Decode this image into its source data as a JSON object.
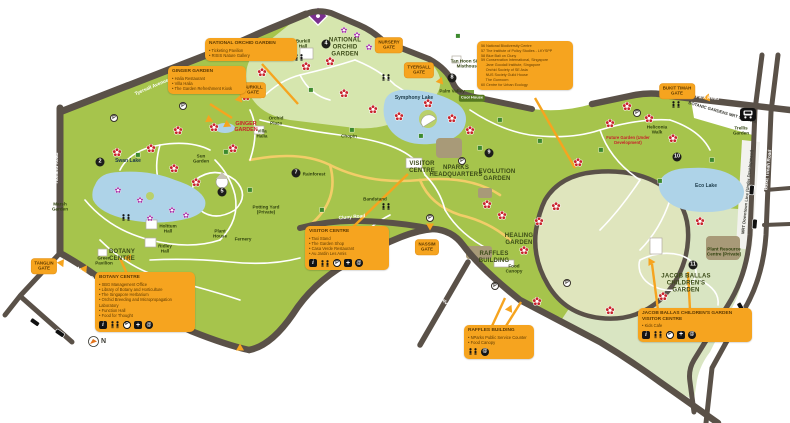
{
  "title": "Singapore Botanic Gardens Visitor Map",
  "colors": {
    "garden_green": "#a6c44c",
    "pale_garden": "#d6e6ae",
    "lawn": "#dfe5bd",
    "road": "#5a5148",
    "water": "#aed3e8",
    "callout_orange": "#f6a41f",
    "callout_text": "#5e3a00",
    "flower_red": "#c8232c",
    "flower_purple": "#a531a8",
    "path_yellow": "#f2cd68"
  },
  "compass": {
    "label": "N"
  },
  "legend_box": {
    "x": 477,
    "y": 41,
    "w": 88,
    "items": [
      {
        "n": "56",
        "t": "National Biodiversity Centre"
      },
      {
        "n": "57",
        "t": "The Institute of Policy Studies - LKYSPP"
      },
      {
        "n": "58",
        "t": "Blue Bali on Cluny"
      },
      {
        "n": "59",
        "t": "Conservation International, Singapore"
      },
      {
        "n": "",
        "t": "Jane Goodall Institute, Singapore"
      },
      {
        "n": "",
        "t": "Orchid Society of SE Asia"
      },
      {
        "n": "",
        "t": "NUS Society Guild House"
      },
      {
        "n": "",
        "t": "The Gunroom"
      },
      {
        "n": "60",
        "t": "Centre for Urban Ecology"
      }
    ],
    "tails": [
      [
        535,
        98,
        575,
        168
      ]
    ]
  },
  "callouts": [
    {
      "slug": "national-orchid-garden",
      "x": 205,
      "y": 38,
      "w": 84,
      "title": "National Orchid Garden",
      "bullets": [
        "Ticketing Pavilion",
        "RISIS Nature Gallery"
      ],
      "icons": [],
      "tails": [
        [
          262,
          64,
          298,
          104
        ]
      ]
    },
    {
      "slug": "ginger-garden",
      "x": 168,
      "y": 66,
      "w": 70,
      "title": "Ginger Garden",
      "bullets": [
        "Halia Restaurant",
        "Villa Halia",
        "The Garden Refreshment Kiosk"
      ],
      "icons": [],
      "tails": [
        [
          210,
          104,
          232,
          118
        ]
      ]
    },
    {
      "slug": "botany-centre",
      "x": 95,
      "y": 272,
      "w": 92,
      "title": "Botany Centre",
      "bullets": [
        "SBG Management Office",
        "Library of Botany and Horticulture",
        "The Singapore Herbarium",
        "Orchid Breeding and Micropropagation Laboratory",
        "Function Hall",
        "Food for Thought"
      ],
      "icons": [
        "info",
        "wc",
        "p",
        "fa",
        "cafe"
      ],
      "tails": [
        [
          127,
          274,
          120,
          258
        ]
      ]
    },
    {
      "slug": "visitor-centre",
      "x": 305,
      "y": 226,
      "w": 76,
      "title": "Visitor Centre",
      "bullets": [
        "Taxi Stand",
        "The Garden Shop",
        "Casa Verde Restaurant",
        "Au Jardin Les Amis"
      ],
      "icons": [
        "info",
        "wc",
        "p",
        "fa",
        "cafe"
      ],
      "tails": [
        [
          352,
          228,
          408,
          174
        ]
      ]
    },
    {
      "slug": "raffles-building",
      "x": 464,
      "y": 325,
      "w": 62,
      "title": "Raffles Building",
      "bullets": [
        "NParks Public Service Counter",
        "Food Canopy"
      ],
      "icons": [
        "wc",
        "cafe"
      ],
      "tails": [
        [
          492,
          326,
          505,
          298
        ],
        [
          506,
          326,
          521,
          302
        ]
      ]
    },
    {
      "slug": "jacob-ballas-visitor-centre",
      "x": 638,
      "y": 308,
      "w": 106,
      "title": "Jacob Ballas Children's Garden Visitor Centre",
      "bullets": [
        "Kids Cafe"
      ],
      "icons": [
        "info",
        "wc",
        "p",
        "fa",
        "cafe"
      ],
      "tails": [
        [
          658,
          310,
          652,
          264
        ],
        [
          690,
          310,
          688,
          272
        ]
      ]
    }
  ],
  "gates": [
    {
      "slug": "tanglin-gate",
      "t": "TANGLIN\nGATE",
      "x": 44,
      "y": 266
    },
    {
      "slug": "nassim-gate",
      "t": "NASSIM\nGATE",
      "x": 427,
      "y": 247
    },
    {
      "slug": "burkill-gate",
      "t": "BURKILL\nGATE",
      "x": 253,
      "y": 90
    },
    {
      "slug": "nursery-gate",
      "t": "NURSERY\nGATE",
      "x": 389,
      "y": 45
    },
    {
      "slug": "tyersall-gate",
      "t": "TYERSALL\nGATE",
      "x": 419,
      "y": 70
    },
    {
      "slug": "bukit-timah-gate",
      "t": "BUKIT TIMAH\nGATE",
      "x": 677,
      "y": 91
    }
  ],
  "map": {
    "labels": [
      {
        "t": "NATIONAL ORCHID GARDEN",
        "x": 345,
        "y": 48,
        "c": "rg",
        "w": 48
      },
      {
        "t": "GINGER GARDEN",
        "x": 246,
        "y": 127,
        "c": "redb",
        "w": 34
      },
      {
        "t": "VISITOR CENTRE",
        "x": 422,
        "y": 168,
        "c": "rg",
        "w": 34
      },
      {
        "t": "NPARKS HEADQUARTERS",
        "x": 456,
        "y": 172,
        "c": "rg",
        "w": 54
      },
      {
        "t": "EVOLUTION GARDEN",
        "x": 497,
        "y": 176,
        "c": "rg",
        "w": 42
      },
      {
        "t": "HEALING GARDEN",
        "x": 519,
        "y": 240,
        "c": "rg",
        "w": 36
      },
      {
        "t": "RAFFLES BUILDING",
        "x": 494,
        "y": 258,
        "c": "rg",
        "w": 38
      },
      {
        "t": "JACOB BALLAS CHILDREN'S GARDEN",
        "x": 686,
        "y": 284,
        "c": "rg",
        "w": 50
      },
      {
        "t": "BOTANY CENTRE",
        "x": 122,
        "y": 256,
        "c": "rg",
        "w": 34
      },
      {
        "t": "Swan Lake",
        "x": 128,
        "y": 162,
        "c": "lk"
      },
      {
        "t": "Symphony Lake",
        "x": 414,
        "y": 99,
        "c": "lk"
      },
      {
        "t": "Eco Lake",
        "x": 706,
        "y": 187,
        "c": "lk"
      },
      {
        "t": "Palm Valley",
        "x": 452,
        "y": 91,
        "c": "ft",
        "w": 26
      },
      {
        "t": "Cool House",
        "x": 472,
        "y": 98,
        "c": "gbox"
      },
      {
        "t": "Burkill Hall",
        "x": 303,
        "y": 44,
        "c": "ft",
        "w": 22
      },
      {
        "t": "Tan Hoon Siang Misthouse",
        "x": 468,
        "y": 64,
        "c": "ft",
        "w": 40
      },
      {
        "t": "Rainforest",
        "x": 314,
        "y": 174,
        "c": "ft"
      },
      {
        "t": "Bandstand",
        "x": 375,
        "y": 199,
        "c": "ft"
      },
      {
        "t": "Marsh Garden",
        "x": 60,
        "y": 207,
        "c": "ft",
        "w": 24
      },
      {
        "t": "Sun Garden",
        "x": 201,
        "y": 159,
        "c": "ft",
        "w": 22
      },
      {
        "t": "Villa Halia",
        "x": 262,
        "y": 134,
        "c": "ft",
        "w": 20
      },
      {
        "t": "Orchid Plaza",
        "x": 276,
        "y": 121,
        "c": "ft",
        "w": 22
      },
      {
        "t": "Plant House",
        "x": 220,
        "y": 234,
        "c": "ft",
        "w": 22
      },
      {
        "t": "Fernery",
        "x": 243,
        "y": 239,
        "c": "ft"
      },
      {
        "t": "Holttum Hall",
        "x": 168,
        "y": 229,
        "c": "ft",
        "w": 24
      },
      {
        "t": "Ridley Hall",
        "x": 165,
        "y": 249,
        "c": "ft",
        "w": 22
      },
      {
        "t": "Green Pavilion",
        "x": 104,
        "y": 261,
        "c": "ft",
        "w": 26
      },
      {
        "t": "Potting Yard (Private)",
        "x": 266,
        "y": 210,
        "c": "ft",
        "w": 30
      },
      {
        "t": "Food Canopy",
        "x": 514,
        "y": 269,
        "c": "ft",
        "w": 24
      },
      {
        "t": "Plant Resource Centre (Private)",
        "x": 724,
        "y": 252,
        "c": "ft",
        "w": 40
      },
      {
        "t": "Trellis Garden",
        "x": 741,
        "y": 131,
        "c": "ft",
        "w": 24
      },
      {
        "t": "Heliconia Walk",
        "x": 657,
        "y": 130,
        "c": "ft",
        "w": 28
      },
      {
        "t": "Chopin",
        "x": 349,
        "y": 136,
        "c": "ft"
      },
      {
        "t": "Future Garden (Under Development)",
        "x": 628,
        "y": 141,
        "c": "redi",
        "w": 44
      },
      {
        "t": "BOTANIC GARDENS MRT STATION",
        "x": 722,
        "y": 113,
        "c": "mrt",
        "r": 16
      },
      {
        "t": "Holland Road",
        "x": 58,
        "y": 168,
        "c": "rd",
        "r": -90
      },
      {
        "t": "Napier Road",
        "x": 88,
        "y": 277,
        "c": "rd",
        "r": 35
      },
      {
        "t": "Tyersall Avenue",
        "x": 152,
        "y": 88,
        "c": "rd",
        "r": -23
      },
      {
        "t": "Cluny Road",
        "x": 352,
        "y": 218,
        "c": "rd",
        "r": -5
      },
      {
        "t": "Cluny Park Road",
        "x": 700,
        "y": 98,
        "c": "rd",
        "r": 5
      },
      {
        "t": "Bukit Timah Road",
        "x": 769,
        "y": 170,
        "c": "rd",
        "r": -84
      },
      {
        "t": "Dalvey Road",
        "x": 449,
        "y": 308,
        "c": "rd",
        "r": 48
      },
      {
        "t": "MRT Downtown Line (Under Development)",
        "x": 748,
        "y": 192,
        "c": "mrt",
        "r": -84
      }
    ],
    "markers": {
      "flowers_red": [
        [
          117,
          153
        ],
        [
          151,
          149
        ],
        [
          178,
          131
        ],
        [
          174,
          169
        ],
        [
          196,
          183
        ],
        [
          214,
          128
        ],
        [
          233,
          149
        ],
        [
          246,
          97
        ],
        [
          262,
          73
        ],
        [
          288,
          44
        ],
        [
          306,
          67
        ],
        [
          330,
          62
        ],
        [
          344,
          94
        ],
        [
          373,
          110
        ],
        [
          399,
          117
        ],
        [
          428,
          104
        ],
        [
          452,
          119
        ],
        [
          470,
          131
        ],
        [
          487,
          205
        ],
        [
          502,
          216
        ],
        [
          524,
          251
        ],
        [
          539,
          222
        ],
        [
          556,
          207
        ],
        [
          578,
          163
        ],
        [
          610,
          124
        ],
        [
          627,
          107
        ],
        [
          649,
          119
        ],
        [
          673,
          139
        ],
        [
          700,
          222
        ],
        [
          663,
          297
        ],
        [
          610,
          311
        ],
        [
          537,
          302
        ]
      ],
      "flowers_purple": [
        [
          140,
          199
        ],
        [
          150,
          217
        ],
        [
          172,
          209
        ],
        [
          186,
          214
        ],
        [
          118,
          189
        ],
        [
          357,
          34
        ],
        [
          344,
          29
        ],
        [
          369,
          46
        ],
        [
          262,
          48
        ]
      ],
      "circles": [
        [
          2,
          100,
          162
        ],
        [
          4,
          326,
          44
        ],
        [
          5,
          222,
          192
        ],
        [
          7,
          296,
          173
        ],
        [
          8,
          452,
          78
        ],
        [
          9,
          489,
          153
        ],
        [
          10,
          677,
          157
        ],
        [
          11,
          693,
          265
        ]
      ],
      "parking": [
        [
          114,
          118
        ],
        [
          183,
          106
        ],
        [
          462,
          161
        ],
        [
          430,
          218
        ],
        [
          495,
          286
        ],
        [
          567,
          283
        ],
        [
          637,
          113
        ]
      ],
      "toilets": [
        [
          299,
          57
        ],
        [
          386,
          77
        ],
        [
          386,
          206
        ],
        [
          676,
          104
        ],
        [
          126,
          217
        ]
      ],
      "squares": [
        [
          138,
          155
        ],
        [
          226,
          152
        ],
        [
          250,
          190
        ],
        [
          311,
          90
        ],
        [
          352,
          130
        ],
        [
          421,
          136
        ],
        [
          500,
          120
        ],
        [
          540,
          141
        ],
        [
          601,
          150
        ],
        [
          660,
          181
        ],
        [
          712,
          160
        ],
        [
          322,
          210
        ],
        [
          458,
          36
        ],
        [
          480,
          148
        ]
      ],
      "triangles": [
        [
          85,
          268,
          35
        ],
        [
          129,
          257,
          35
        ],
        [
          190,
          305,
          35
        ],
        [
          210,
          120,
          115
        ],
        [
          228,
          125,
          115
        ],
        [
          381,
          42,
          140
        ],
        [
          441,
          82,
          140
        ],
        [
          430,
          227,
          180
        ],
        [
          510,
          308,
          25
        ],
        [
          652,
          262,
          90
        ],
        [
          240,
          347,
          0
        ],
        [
          62,
          262,
          35
        ],
        [
          706,
          98,
          -100
        ],
        [
          240,
          100,
          140
        ]
      ],
      "bus_stops": [
        [
          752,
          190,
          95
        ],
        [
          755,
          224,
          95
        ],
        [
          741,
          307,
          60
        ],
        [
          748,
          321,
          60
        ],
        [
          35,
          322,
          35
        ],
        [
          60,
          333,
          35
        ]
      ]
    }
  }
}
